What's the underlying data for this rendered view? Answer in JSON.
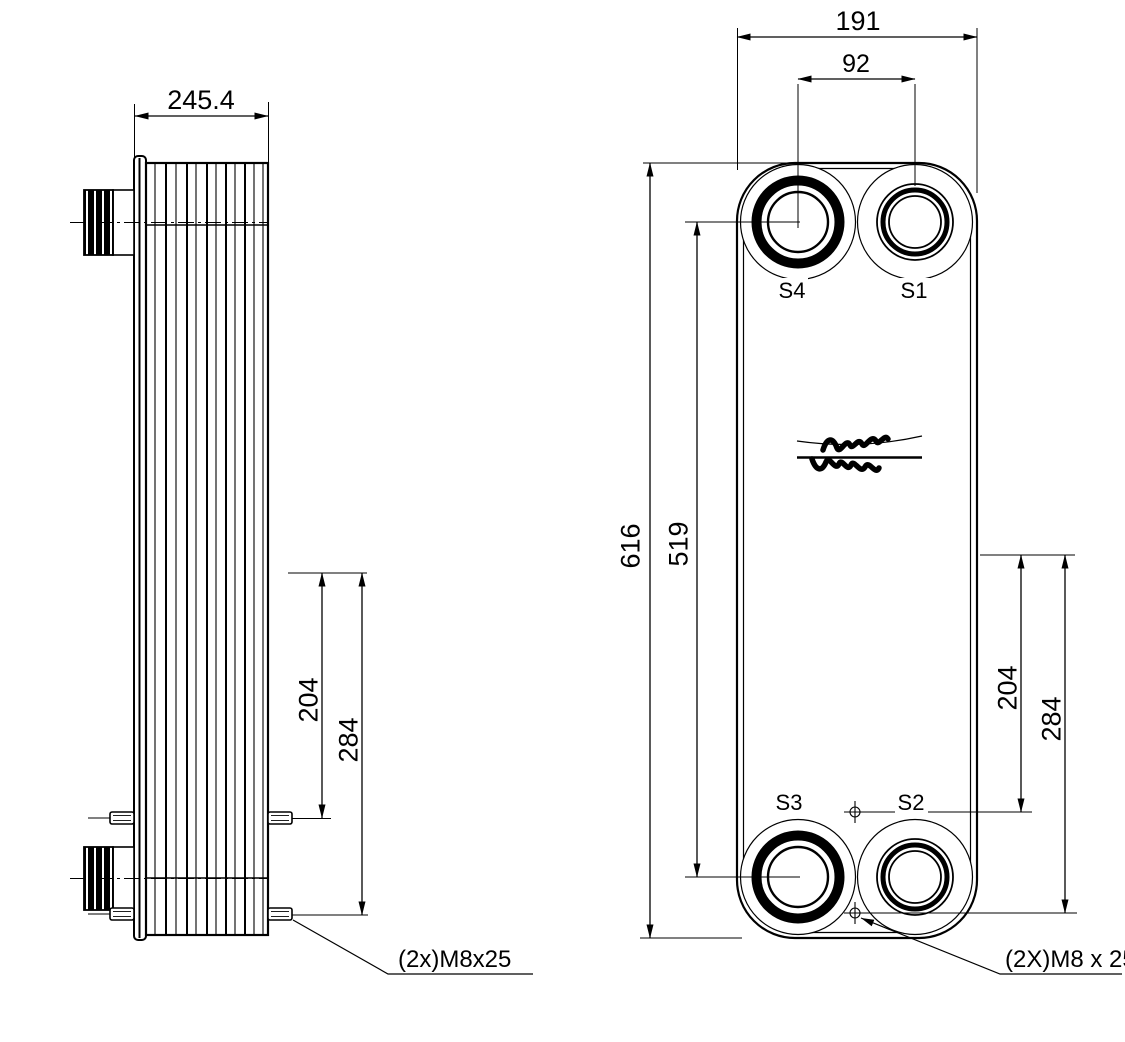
{
  "drawing": {
    "type": "technical-dimension-drawing",
    "line_color": "#000000",
    "background_color": "#ffffff"
  },
  "side_view": {
    "depth_dim": "245.4",
    "upper_stud_dim": "204",
    "lower_stud_dim": "284",
    "stud_note": "(2x)M8x25"
  },
  "front_view": {
    "width_dim": "191",
    "port_spacing_dim": "92",
    "height_dim": "616",
    "port_vertical_dim": "519",
    "upper_stud_dim": "204",
    "lower_stud_dim": "284",
    "stud_note": "(2X)M8 x 25",
    "port_labels": {
      "s4": "S4",
      "s1": "S1",
      "s3": "S3",
      "s2": "S2"
    },
    "logo": "Alfa Laval"
  }
}
